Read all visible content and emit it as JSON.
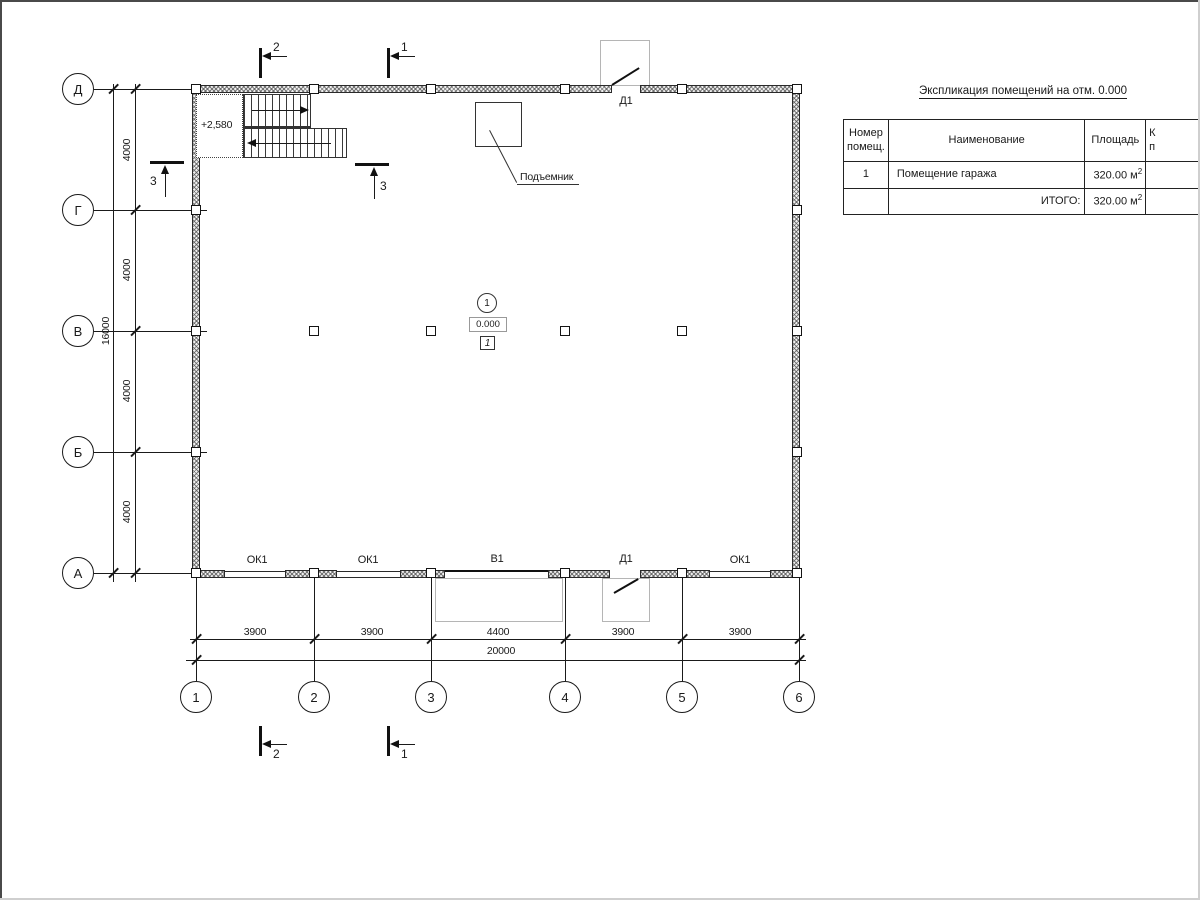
{
  "spec_table": {
    "title": "Экспликация помещений на отм. 0.000",
    "header_num": "Номер помещ.",
    "header_name": "Наименование",
    "header_area": "Площадь",
    "header_cat_l1": "К",
    "header_cat_l2": "п",
    "row": {
      "num": "1",
      "name": "Помещение гаража",
      "area": "320.00 м",
      "area_sup": "2"
    },
    "total": {
      "label": "ИТОГО:",
      "area": "320.00 м",
      "area_sup": "2"
    }
  },
  "axes": {
    "rows": [
      "Д",
      "Г",
      "В",
      "Б",
      "А"
    ],
    "cols": [
      "1",
      "2",
      "3",
      "4",
      "5",
      "6"
    ]
  },
  "dims": {
    "left": [
      "4000",
      "4000",
      "4000",
      "4000"
    ],
    "left_total": "16000",
    "bottom": [
      "3900",
      "3900",
      "4400",
      "3900",
      "3900"
    ],
    "bottom_total": "20000"
  },
  "sections": {
    "s1": "1",
    "s2": "2",
    "s3": "3"
  },
  "plan": {
    "door_label": "Д1",
    "window_label": "ОК1",
    "gate_label": "В1",
    "hoist_label": "Подъемник",
    "stair_elevation": "+2,580",
    "room_number": "1",
    "room_elevation": "0.000",
    "room_type_tag": "1"
  },
  "colors": {
    "line": "#1a1a1a",
    "hatch": "#555555",
    "light_line": "#b5b5b5",
    "background": "#ffffff"
  }
}
